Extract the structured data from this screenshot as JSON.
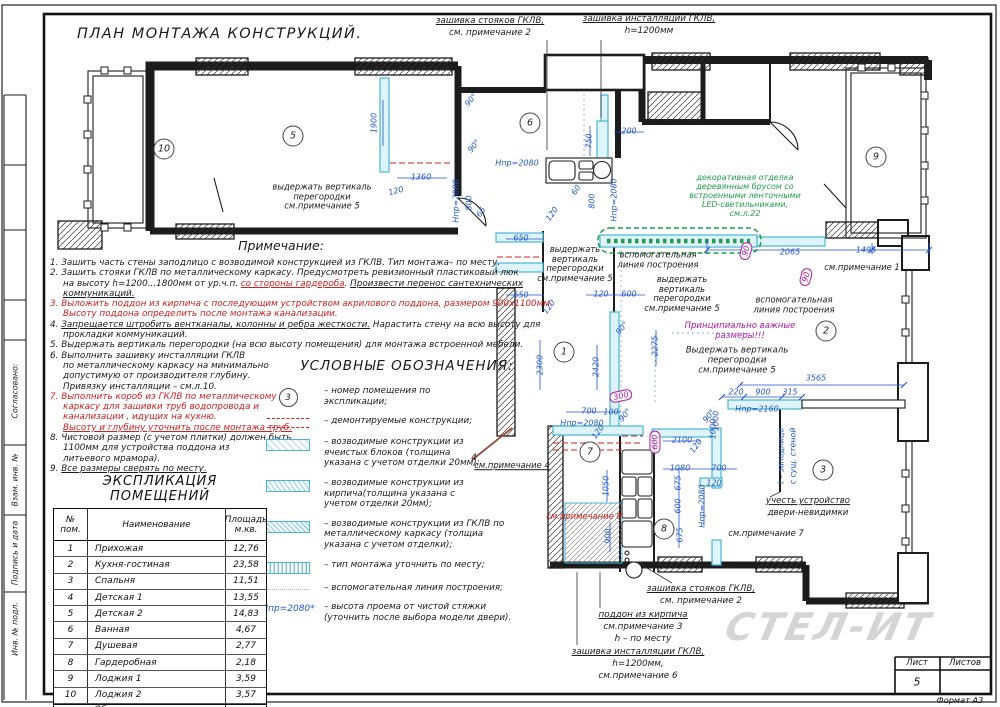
{
  "title": "ПЛАН МОНТАЖА КОНСТРУКЦИЙ.",
  "colors": {
    "dim": "#2456c9",
    "red": "#d02020",
    "grn": "#1f9d4b",
    "mag": "#b517a8",
    "blk": "#1a1a1a",
    "cyan_fill": "#dff4fa",
    "cyan_line": "#49b6d6"
  },
  "sidebar": {
    "items": [
      {
        "label": "Согласовано:",
        "y": 391
      },
      {
        "label": "Взам. инв. №",
        "y": 480
      },
      {
        "label": "Подпись и дата",
        "y": 553
      },
      {
        "label": "Инв. № подл.",
        "y": 629
      }
    ]
  },
  "notes": {
    "title": "Примечание:",
    "lines": [
      {
        "s": [
          {
            "t": "1. Зашить часть стены заподлицо с возводимой конструкцией из ГКЛВ. Тип монтажа– по месту."
          }
        ]
      },
      {
        "s": [
          {
            "t": "2. Зашить стояки ГКЛВ по металлическому каркасу. Предусмотреть ревизионный пластиковый люк"
          }
        ]
      },
      {
        "ind": 1,
        "s": [
          {
            "t": "на высоту h=1200...1800мм от ур.ч.п. "
          },
          {
            "t": "со стороны гардероба",
            "c": "red",
            "u": 1
          },
          {
            "t": ". "
          },
          {
            "t": "Произвести перенос сантехнических",
            "u": 1
          }
        ]
      },
      {
        "ind": 1,
        "s": [
          {
            "t": "коммуникаций.",
            "u": 1
          }
        ]
      },
      {
        "s": [
          {
            "t": "3. Выложить поддон из кирпича с последующим устройством акрилового поддона, размером 900х1100мм.",
            "c": "red"
          }
        ]
      },
      {
        "ind": 1,
        "s": [
          {
            "t": "Высоту поддона определить после  монтажа канализации.",
            "c": "red"
          }
        ]
      },
      {
        "s": [
          {
            "t": "4. "
          },
          {
            "t": "Запрещается штробить вентканалы, колонны и ребра жесткости.",
            "u": 1
          },
          {
            "t": " Нарастить стену на всю высоту для"
          }
        ]
      },
      {
        "ind": 1,
        "s": [
          {
            "t": "прокладки коммуникаций."
          }
        ]
      },
      {
        "s": [
          {
            "t": "5. Выдержать вертикаль перегородки (на всю высоту помещения) для монтажа встроенной  мебели."
          }
        ]
      },
      {
        "s": [
          {
            "t": "6. Выполнить зашивку инсталляции ГКЛВ"
          }
        ]
      },
      {
        "ind": 1,
        "s": [
          {
            "t": "по металлическому каркасу на минимально"
          }
        ]
      },
      {
        "ind": 1,
        "s": [
          {
            "t": "допустимую от производителя глубину."
          }
        ]
      },
      {
        "ind": 1,
        "s": [
          {
            "t": "Привязку инсталляции – см.л.10."
          }
        ]
      },
      {
        "s": [
          {
            "t": "7. Выполнить короб из ГКЛВ по металлическому",
            "c": "red"
          }
        ]
      },
      {
        "ind": 1,
        "s": [
          {
            "t": "каркасу для зашивки труб водопровода и",
            "c": "red"
          }
        ]
      },
      {
        "ind": 1,
        "s": [
          {
            "t": "канализации , идущих на кухню.",
            "c": "red"
          }
        ]
      },
      {
        "ind": 1,
        "s": [
          {
            "t": "Высоту и глубину уточнить после монтажа труб.",
            "c": "red",
            "u": 1
          }
        ]
      },
      {
        "s": [
          {
            "t": "8. Чистовой размер (с учетом плитки) должен быть"
          }
        ]
      },
      {
        "ind": 1,
        "s": [
          {
            "t": "1100мм для устройства поддона из"
          }
        ]
      },
      {
        "ind": 1,
        "s": [
          {
            "t": "литьевого мрамора)."
          }
        ]
      },
      {
        "s": [
          {
            "t": "9. "
          },
          {
            "t": "Все размеры сверять по месту.",
            "u": 1
          }
        ]
      }
    ]
  },
  "legend": {
    "title": "УСЛОВНЫЕ ОБОЗНАЧЕНИЯ:",
    "items": [
      {
        "sym": "num",
        "num": "3",
        "text": "– номер помещения по\nэкспликации;"
      },
      {
        "sym": "demo",
        "text": "– демонтируемые конструкции;"
      },
      {
        "sym": "blocks",
        "text": "– возводимые конструкции из\nячеистых блоков (толщина\nуказана с учетом отделки 20мм);"
      },
      {
        "sym": "brick",
        "text": "– возводимые конструкции из\nкирпича(толщина указана с\nучетом отделки 20мм);"
      },
      {
        "sym": "gklv",
        "text": "– возводимые конструкции из ГКЛВ по\nметаллическому каркасу (толщиа\nуказана с учетом отделки);"
      },
      {
        "sym": "vert",
        "text": "– тип монтажа уточнить по месту;"
      },
      {
        "sym": "dots",
        "text": "– вспомогательная линия построения;"
      },
      {
        "sym": "hpr",
        "symtext": "Hпр=2080*",
        "text": "– высота проема от чистой стяжки\n(уточнить после выбора модели двери)."
      }
    ]
  },
  "table": {
    "title": "ЭКСПЛИКАЦИЯ ПОМЕЩЕНИЙ",
    "headers": [
      "№\nпом.",
      "Наименование",
      "Площадь\nм.кв."
    ],
    "rows": [
      [
        "1",
        "Прихожая",
        "12,76"
      ],
      [
        "2",
        "Кухня-гостиная",
        "23,58"
      ],
      [
        "3",
        "Спальня",
        "11,51"
      ],
      [
        "4",
        "Детская 1",
        "13,55"
      ],
      [
        "5",
        "Детская 2",
        "14,83"
      ],
      [
        "6",
        "Ванная",
        "4,67"
      ],
      [
        "7",
        "Душевая",
        "2,77"
      ],
      [
        "8",
        "Гардеробная",
        "2,18"
      ],
      [
        "9",
        "Лоджия 1",
        "3,59"
      ],
      [
        "10",
        "Лоджия 2",
        "3,57"
      ]
    ],
    "total_label": "Общая площадь помещений",
    "total_value": "93,01"
  },
  "titleblock": {
    "sheet_label": "Лист",
    "sheets_label": "Листов",
    "sheet_number": "5",
    "format_label": "Формат А3",
    "watermark": "СТЕЛ-ИТ"
  },
  "plan": {
    "rooms": [
      {
        "n": "10",
        "x": 164,
        "y": 149
      },
      {
        "n": "5",
        "x": 293,
        "y": 136
      },
      {
        "n": "6",
        "x": 530,
        "y": 123
      },
      {
        "n": "9",
        "x": 876,
        "y": 157
      },
      {
        "n": "1",
        "x": 564,
        "y": 352
      },
      {
        "n": "2",
        "x": 826,
        "y": 331
      },
      {
        "n": "7",
        "x": 590,
        "y": 452
      },
      {
        "n": "8",
        "x": 664,
        "y": 529
      },
      {
        "n": "3",
        "x": 823,
        "y": 470
      }
    ],
    "labels": [
      {
        "t": "зашивка стояков ГКЛВ,",
        "x": 490,
        "y": 21,
        "c": "blk",
        "fs": 8.8,
        "u": 1
      },
      {
        "t": "см. примечание 2",
        "x": 490,
        "y": 33,
        "c": "blk",
        "fs": 8.8
      },
      {
        "t": "зашивка инсталляции ГКЛВ,",
        "x": 649,
        "y": 19,
        "c": "blk",
        "fs": 8.8,
        "u": 1
      },
      {
        "t": "h=1200мм",
        "x": 649,
        "y": 31,
        "c": "blk",
        "fs": 8.8
      },
      {
        "t": "1900",
        "x": 374,
        "y": 123,
        "r": -90
      },
      {
        "t": "1360",
        "x": 421,
        "y": 177
      },
      {
        "t": "120",
        "x": 396,
        "y": 191,
        "r": -15
      },
      {
        "t": "Hпр=2080",
        "x": 456,
        "y": 201,
        "r": -90
      },
      {
        "t": "90°",
        "x": 471,
        "y": 100,
        "r": -50
      },
      {
        "t": "90°",
        "x": 474,
        "y": 146,
        "r": -50
      },
      {
        "t": "750",
        "x": 589,
        "y": 141,
        "r": -90
      },
      {
        "t": "200",
        "x": 629,
        "y": 131
      },
      {
        "t": "Hпр=2080",
        "x": 517,
        "y": 163
      },
      {
        "t": "800",
        "x": 469,
        "y": 203,
        "r": -90
      },
      {
        "t": "65",
        "x": 481,
        "y": 212,
        "r": -55
      },
      {
        "t": "120",
        "x": 552,
        "y": 214,
        "r": -55
      },
      {
        "t": "60",
        "x": 576,
        "y": 190,
        "r": -55
      },
      {
        "t": "800",
        "x": 592,
        "y": 201,
        "r": -90
      },
      {
        "t": "Hпр=2080",
        "x": 614,
        "y": 200,
        "r": -90
      },
      {
        "t": "выдержать вертикаль\nперегородки\nсм.примечание 5",
        "x": 322,
        "y": 197,
        "c": "blk",
        "fs": 8.4
      },
      {
        "t": "выдержать\nвертикаль\nперегородки\nсм.примечание 5",
        "x": 575,
        "y": 264,
        "c": "blk",
        "fs": 8.4
      },
      {
        "t": "выдержать\nвертикаль\nперегородки\nсм.примечание 5",
        "x": 682,
        "y": 294,
        "c": "blk",
        "fs": 8.4
      },
      {
        "t": "вспомогательная\nлиния построения",
        "x": 658,
        "y": 260,
        "c": "blk",
        "fs": 8.4
      },
      {
        "t": "вспомогательная\nлиния построения",
        "x": 794,
        "y": 305,
        "c": "blk",
        "fs": 8.4
      },
      {
        "t": "Принципиально важные\nразмеры!!!",
        "x": 740,
        "y": 332,
        "c": "mag",
        "fs": 8.6
      },
      {
        "t": "Выдержать вертикаль\nперегородки\nсм.примечание 5",
        "x": 737,
        "y": 361,
        "c": "blk",
        "fs": 8.6
      },
      {
        "t": "декоративная отделка\nдеревянным брусом со\nвстроенными ленточными\nLED-светильниками,\nсм.л.22",
        "x": 745,
        "y": 196,
        "c": "grn",
        "fs": 8
      },
      {
        "t": "2065",
        "x": 790,
        "y": 252
      },
      {
        "t": "1495",
        "x": 866,
        "y": 250
      },
      {
        "t": "см.примечание 1",
        "x": 862,
        "y": 268,
        "c": "blk",
        "fs": 8.4
      },
      {
        "t": "650",
        "x": 521,
        "y": 238
      },
      {
        "t": "650",
        "x": 521,
        "y": 295
      },
      {
        "t": "120",
        "x": 549,
        "y": 307,
        "r": -55
      },
      {
        "t": "120",
        "x": 601,
        "y": 294
      },
      {
        "t": "600",
        "x": 629,
        "y": 294
      },
      {
        "t": "90°",
        "x": 622,
        "y": 328,
        "r": -50
      },
      {
        "t": "2300",
        "x": 540,
        "y": 365,
        "r": -90
      },
      {
        "t": "2420",
        "x": 596,
        "y": 367,
        "r": -90
      },
      {
        "t": "2275",
        "x": 655,
        "y": 346,
        "r": -90
      },
      {
        "t": "3565",
        "x": 816,
        "y": 378
      },
      {
        "t": "220",
        "x": 736,
        "y": 392
      },
      {
        "t": "900",
        "x": 763,
        "y": 392
      },
      {
        "t": "315",
        "x": 790,
        "y": 392
      },
      {
        "t": "Hпр=2160",
        "x": 757,
        "y": 409
      },
      {
        "t": "1000",
        "x": 716,
        "y": 421,
        "r": -90
      },
      {
        "t": "t – заподлицо",
        "x": 782,
        "y": 456,
        "r": -90,
        "fs": 7.8
      },
      {
        "t": "с сущ. стеной",
        "x": 794,
        "y": 456,
        "r": -90,
        "fs": 7.8
      },
      {
        "t": "учесть устройство",
        "x": 808,
        "y": 502,
        "c": "blk",
        "fs": 8.6,
        "u": 1
      },
      {
        "t": "двери-невидимки",
        "x": 808,
        "y": 514,
        "c": "blk",
        "fs": 8.6
      },
      {
        "t": "см.примечание 7",
        "x": 766,
        "y": 534,
        "c": "blk",
        "fs": 8.4
      },
      {
        "t": "700",
        "x": 589,
        "y": 411
      },
      {
        "t": "100",
        "x": 611,
        "y": 412
      },
      {
        "t": "90°",
        "x": 625,
        "y": 415,
        "r": -50
      },
      {
        "t": "300",
        "x": 621,
        "y": 396,
        "c": "mag",
        "box": 1,
        "r": -12
      },
      {
        "t": "600",
        "x": 655,
        "y": 442,
        "c": "mag",
        "box": 1,
        "r": -90
      },
      {
        "t": "90",
        "x": 746,
        "y": 251,
        "c": "mag",
        "box": 1,
        "r": -75
      },
      {
        "t": "90",
        "x": 806,
        "y": 277,
        "c": "mag",
        "box": 1,
        "r": -75
      },
      {
        "t": "Hпр=2080",
        "x": 582,
        "y": 423
      },
      {
        "t": "120",
        "x": 598,
        "y": 432,
        "r": -55
      },
      {
        "t": "2100",
        "x": 682,
        "y": 440
      },
      {
        "t": "120",
        "x": 696,
        "y": 446,
        "r": -55
      },
      {
        "t": "90°",
        "x": 709,
        "y": 416,
        "r": -50
      },
      {
        "t": "1000",
        "x": 713,
        "y": 429,
        "r": -90
      },
      {
        "t": "1080",
        "x": 680,
        "y": 468
      },
      {
        "t": "700",
        "x": 719,
        "y": 468
      },
      {
        "t": "120",
        "x": 714,
        "y": 483
      },
      {
        "t": "675",
        "x": 678,
        "y": 483,
        "r": -90
      },
      {
        "t": "600",
        "x": 678,
        "y": 506,
        "r": -90
      },
      {
        "t": "675",
        "x": 680,
        "y": 535,
        "r": -90
      },
      {
        "t": "Hпр=2080",
        "x": 702,
        "y": 506,
        "r": -90
      },
      {
        "t": "1050",
        "x": 606,
        "y": 486,
        "r": -90
      },
      {
        "t": "900",
        "x": 608,
        "y": 536,
        "r": -90
      },
      {
        "t": "см.примечание 8",
        "x": 584,
        "y": 517,
        "c": "red",
        "fs": 8.4
      },
      {
        "t": "см.примечание 4",
        "x": 512,
        "y": 466,
        "c": "blk",
        "fs": 8.4,
        "u": 1
      },
      {
        "t": "4",
        "x": 474,
        "y": 459,
        "c": "blk",
        "fs": 8.5
      },
      {
        "t": "зашивка стояков ГКЛВ,",
        "x": 701,
        "y": 589,
        "c": "blk",
        "fs": 8.8,
        "u": 1
      },
      {
        "t": "см. примечание 2",
        "x": 701,
        "y": 601,
        "c": "blk",
        "fs": 8.8
      },
      {
        "t": "поддон из кирпича",
        "x": 643,
        "y": 615,
        "c": "blk",
        "fs": 8.8,
        "u": 1
      },
      {
        "t": "см.примечание 3",
        "x": 643,
        "y": 627,
        "c": "blk",
        "fs": 8.8
      },
      {
        "t": "h – по месту",
        "x": 643,
        "y": 639,
        "c": "blk",
        "fs": 8.8
      },
      {
        "t": "зашивка инсталляции ГКЛВ,",
        "x": 638,
        "y": 652,
        "c": "blk",
        "fs": 8.8,
        "u": 1
      },
      {
        "t": "h=1200мм,",
        "x": 638,
        "y": 664,
        "c": "blk",
        "fs": 8.8
      },
      {
        "t": "см.примечание 6",
        "x": 638,
        "y": 676,
        "c": "blk",
        "fs": 8.8
      }
    ]
  }
}
